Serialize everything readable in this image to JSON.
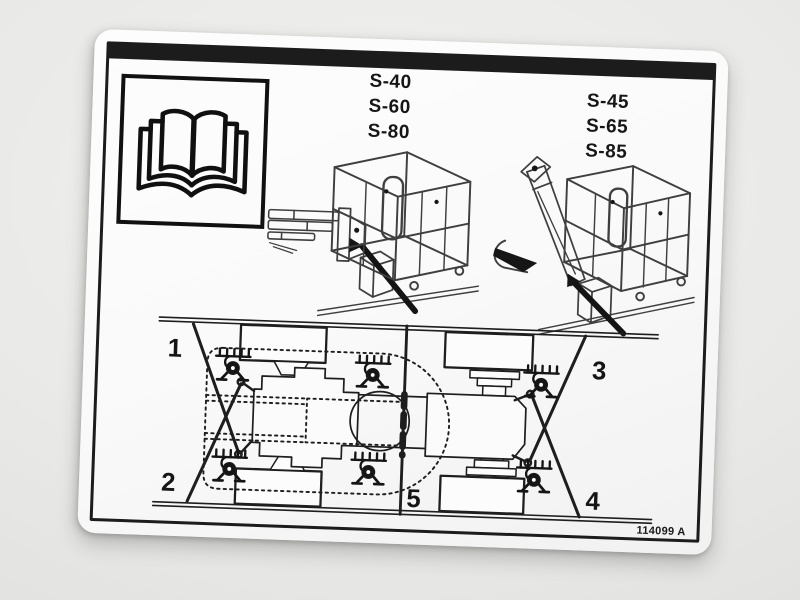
{
  "scene": {
    "description": "photo of white instruction decal on gray background",
    "photo_background": "#e9e9e7",
    "label_background": "#fafafa",
    "ink_color": "#1c1c1c"
  },
  "label": {
    "manual_icon": "open-book-icon",
    "model_groups": [
      {
        "models": [
          "S-40",
          "S-60",
          "S-80"
        ]
      },
      {
        "models": [
          "S-45",
          "S-65",
          "S-85"
        ]
      }
    ],
    "drawings": {
      "left": "stowed-boom-lift-with-tie-down-strap",
      "right": "jib-boom-lift-with-tie-down-strap",
      "bottom": "chassis-top-view-tie-down-points"
    },
    "tie_down_labels": [
      "1",
      "2",
      "3",
      "4",
      "5"
    ],
    "part_number": "114099 A"
  }
}
